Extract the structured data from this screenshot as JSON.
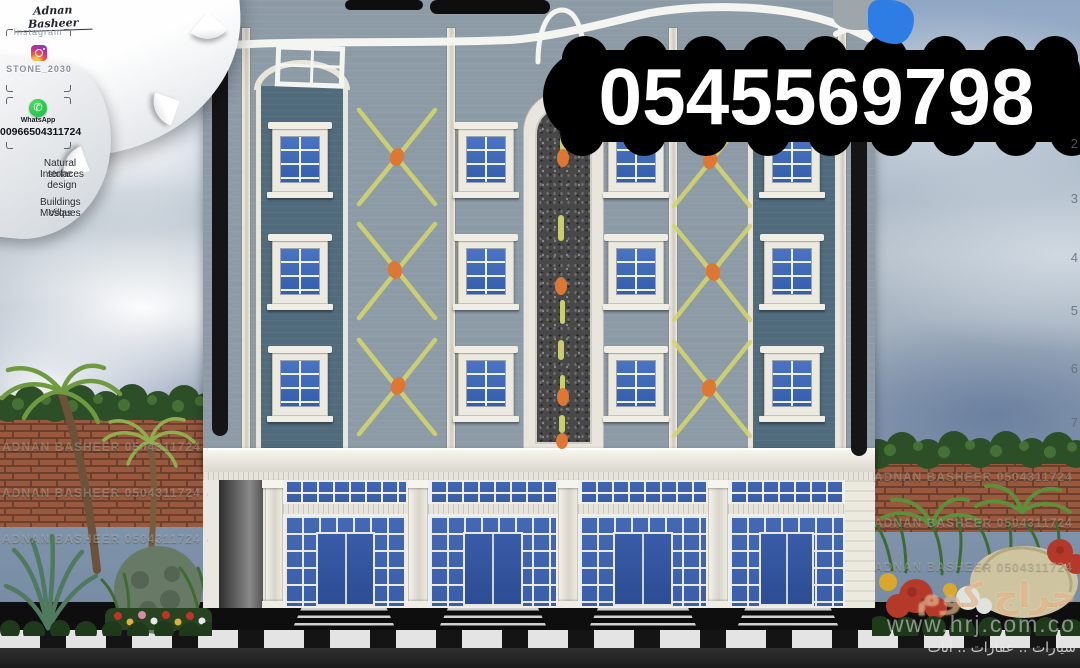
{
  "banner": {
    "phone": "0545569798"
  },
  "sidebar": {
    "signature": "Adnan Basheer",
    "instagram_label": "Instagram",
    "instagram_handle": "STONE_2030",
    "whatsapp_label": "WhatsApp",
    "whatsapp_glyph": "✆",
    "whatsapp_number": "00966504311724",
    "tagline_line1": "Natural stone",
    "tagline_line2": "Interfaces design",
    "tagline_line3": "Buildings Villas",
    "tagline_line4": "Mosques"
  },
  "page_numbers": [
    "2",
    "3",
    "4",
    "5",
    "6",
    "7"
  ],
  "watermark": {
    "tile": "ADNAN BASHEER 0504311724 ٠٥٠٤٣١١٧٢٤",
    "site_name": "حراج كوم",
    "site_url": "www.hrj.com.co",
    "site_tagline": "سيارات .. عقارات .. أثاث"
  },
  "colors": {
    "facade": "#8d9ba6",
    "panel": "#506b7c",
    "frame": "#ece9e0",
    "glass_top": "#4a74c4",
    "glass_bottom": "#355dab",
    "shop_glass": "#4468b4",
    "door": "#2c4d93",
    "sketch_yellow": "#d2d56d",
    "sketch_orange": "#dd7733",
    "banner_bg": "#000000",
    "banner_text": "#ffffff",
    "brick": "#98593f",
    "hedge": "#2d4f28",
    "road": "#1c1c1c",
    "curb_white": "#e4e4e4",
    "sky_top": "#90a7c4",
    "sky_bottom": "#72869f",
    "whatsapp_green": "#25c24b"
  }
}
